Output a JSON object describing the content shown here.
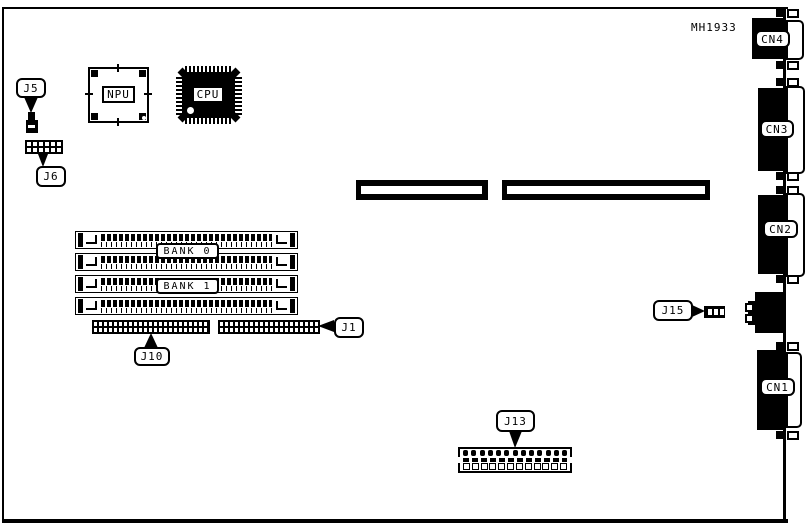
{
  "diagram": {
    "board_code": "MH1933",
    "colors": {
      "ink": "#000000",
      "paper": "#ffffff"
    },
    "chips": {
      "npu": "NPU",
      "cpu": "CPU"
    },
    "memory": {
      "socket_count": 4,
      "bank_labels": [
        "BANK 0",
        "BANK 1"
      ]
    },
    "jumpers": {
      "j5": "J5",
      "j6": "J6",
      "j10": "J10",
      "j1": "J1",
      "j13": "J13",
      "j15": "J15"
    },
    "rear_connectors": {
      "cn4": "CN4",
      "cn3": "CN3",
      "cn2": "CN2",
      "cn1": "CN1"
    },
    "counts": {
      "j6_cells": 12,
      "j13_top_bumps": 13,
      "j13_bottom_cells": 12,
      "j15_cells": 3,
      "expansion_slots": 2
    }
  }
}
